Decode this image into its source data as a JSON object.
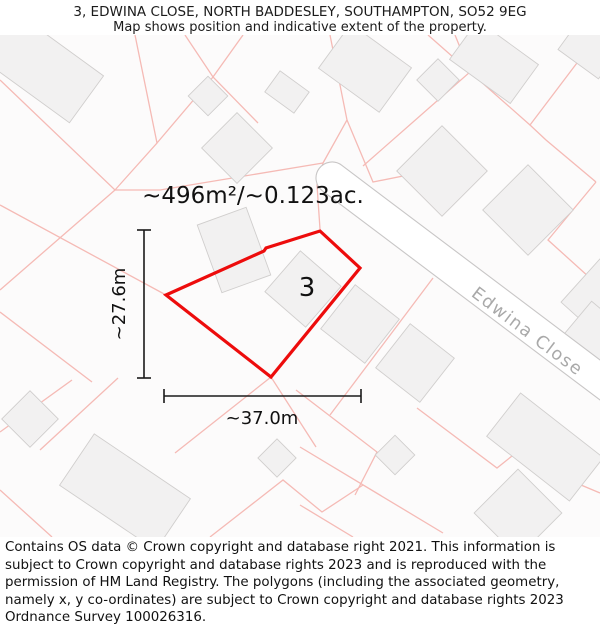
{
  "header": {
    "title": "3, EDWINA CLOSE, NORTH BADDESLEY, SOUTHAMPTON, SO52 9EG",
    "subtitle": "Map shows position and indicative extent of the property."
  },
  "map": {
    "bg": "#fcfbfb",
    "building_fill": "#f2f1f1",
    "building_stroke": "#d0cecd",
    "parcel_color": "#f5bab5",
    "dim_color": "#1a1a1a",
    "road": {
      "label": "Edwina Close",
      "label_color": "#a9a9a9",
      "edge_color": "#c8c6c6",
      "cx": 332,
      "cy": 143,
      "angle": 37,
      "length": 420,
      "width": 32,
      "label_x": 524,
      "label_y": 301
    },
    "buildings": [
      [
        42,
        32,
        110,
        58,
        36
      ],
      [
        208,
        61,
        28,
        28,
        45
      ],
      [
        237,
        113,
        50,
        50,
        45
      ],
      [
        287,
        57,
        36,
        26,
        36
      ],
      [
        365,
        33,
        75,
        55,
        36
      ],
      [
        438,
        45,
        30,
        30,
        45
      ],
      [
        494,
        27,
        75,
        48,
        36
      ],
      [
        590,
        13,
        50,
        40,
        36
      ],
      [
        442,
        136,
        64,
        64,
        45
      ],
      [
        528,
        175,
        64,
        64,
        45
      ],
      [
        602,
        265,
        58,
        58,
        42
      ],
      [
        234,
        215,
        52,
        72,
        -20
      ],
      [
        303,
        254,
        54,
        54,
        41
      ],
      [
        360,
        289,
        56,
        56,
        38
      ],
      [
        415,
        328,
        56,
        56,
        38
      ],
      [
        595,
        305,
        55,
        55,
        40
      ],
      [
        30,
        384,
        40,
        40,
        45
      ],
      [
        125,
        457,
        116,
        62,
        34
      ],
      [
        277,
        423,
        27,
        27,
        45
      ],
      [
        395,
        420,
        28,
        28,
        45
      ],
      [
        545,
        412,
        105,
        55,
        38
      ],
      [
        518,
        478,
        62,
        62,
        45
      ]
    ],
    "parcel_lines": [
      [
        [
          0,
          45
        ],
        [
          115,
          155
        ],
        [
          160,
          155
        ],
        [
          323,
          128
        ]
      ],
      [
        [
          115,
          155
        ],
        [
          0,
          255
        ]
      ],
      [
        [
          135,
          0
        ],
        [
          157,
          108
        ],
        [
          115,
          155
        ]
      ],
      [
        [
          157,
          108
        ],
        [
          213,
          42
        ],
        [
          243,
          0
        ]
      ],
      [
        [
          185,
          0
        ],
        [
          213,
          42
        ],
        [
          258,
          88
        ]
      ],
      [
        [
          330,
          0
        ],
        [
          347,
          85
        ],
        [
          323,
          128
        ]
      ],
      [
        [
          323,
          128
        ],
        [
          317,
          150
        ],
        [
          320,
          194
        ]
      ],
      [
        [
          347,
          85
        ],
        [
          373,
          147
        ],
        [
          428,
          136
        ]
      ],
      [
        [
          455,
          0
        ],
        [
          470,
          37
        ],
        [
          363,
          131
        ]
      ],
      [
        [
          428,
          0
        ],
        [
          470,
          37
        ],
        [
          530,
          90
        ]
      ],
      [
        [
          583,
          20
        ],
        [
          530,
          90
        ],
        [
          546,
          105
        ],
        [
          596,
          147
        ]
      ],
      [
        [
          575,
          0
        ],
        [
          600,
          23
        ]
      ],
      [
        [
          596,
          147
        ],
        [
          548,
          205
        ],
        [
          600,
          252
        ]
      ],
      [
        [
          433,
          243
        ],
        [
          330,
          380
        ]
      ],
      [
        [
          296,
          355
        ],
        [
          377,
          417
        ],
        [
          355,
          460
        ]
      ],
      [
        [
          417,
          373
        ],
        [
          497,
          433
        ],
        [
          512,
          421
        ],
        [
          600,
          458
        ]
      ],
      [
        [
          300,
          412
        ],
        [
          443,
          498
        ]
      ],
      [
        [
          300,
          470
        ],
        [
          353,
          502
        ]
      ],
      [
        [
          210,
          502
        ],
        [
          283,
          445
        ],
        [
          322,
          477
        ],
        [
          363,
          450
        ]
      ],
      [
        [
          72,
          345
        ],
        [
          0,
          397
        ]
      ],
      [
        [
          118,
          343
        ],
        [
          40,
          415
        ]
      ],
      [
        [
          0,
          277
        ],
        [
          92,
          347
        ]
      ],
      [
        [
          0,
          170
        ],
        [
          166,
          260
        ]
      ],
      [
        [
          271,
          342
        ],
        [
          316,
          412
        ]
      ],
      [
        [
          271,
          342
        ],
        [
          175,
          418
        ]
      ],
      [
        [
          0,
          455
        ],
        [
          52,
          502
        ]
      ]
    ],
    "property": {
      "color": "#ed0c0c",
      "stroke_width": 3.2,
      "points": [
        [
          166,
          260
        ],
        [
          264,
          216
        ],
        [
          266,
          213
        ],
        [
          320,
          196
        ],
        [
          360,
          233
        ],
        [
          271,
          342
        ]
      ],
      "label": "3",
      "label_x": 307,
      "label_y": 261,
      "label_size": 26
    },
    "area_label": {
      "text": "~496m²/~0.123ac.",
      "x": 253,
      "y": 168,
      "size": 23
    },
    "dim_v": {
      "label": "~27.6m",
      "x": 144,
      "y1": 195,
      "y2": 343,
      "label_x": 125,
      "label_y": 269,
      "size": 18
    },
    "dim_h": {
      "label": "~37.0m",
      "y": 361,
      "x1": 164,
      "x2": 361,
      "label_x": 262,
      "label_y": 389,
      "size": 18
    }
  },
  "footer": {
    "text": "Contains OS data © Crown copyright and database right 2021. This information is subject to Crown copyright and database rights 2023 and is reproduced with the permission of HM Land Registry. The polygons (including the associated geometry, namely x, y co-ordinates) are subject to Crown copyright and database rights 2023 Ordnance Survey 100026316."
  }
}
